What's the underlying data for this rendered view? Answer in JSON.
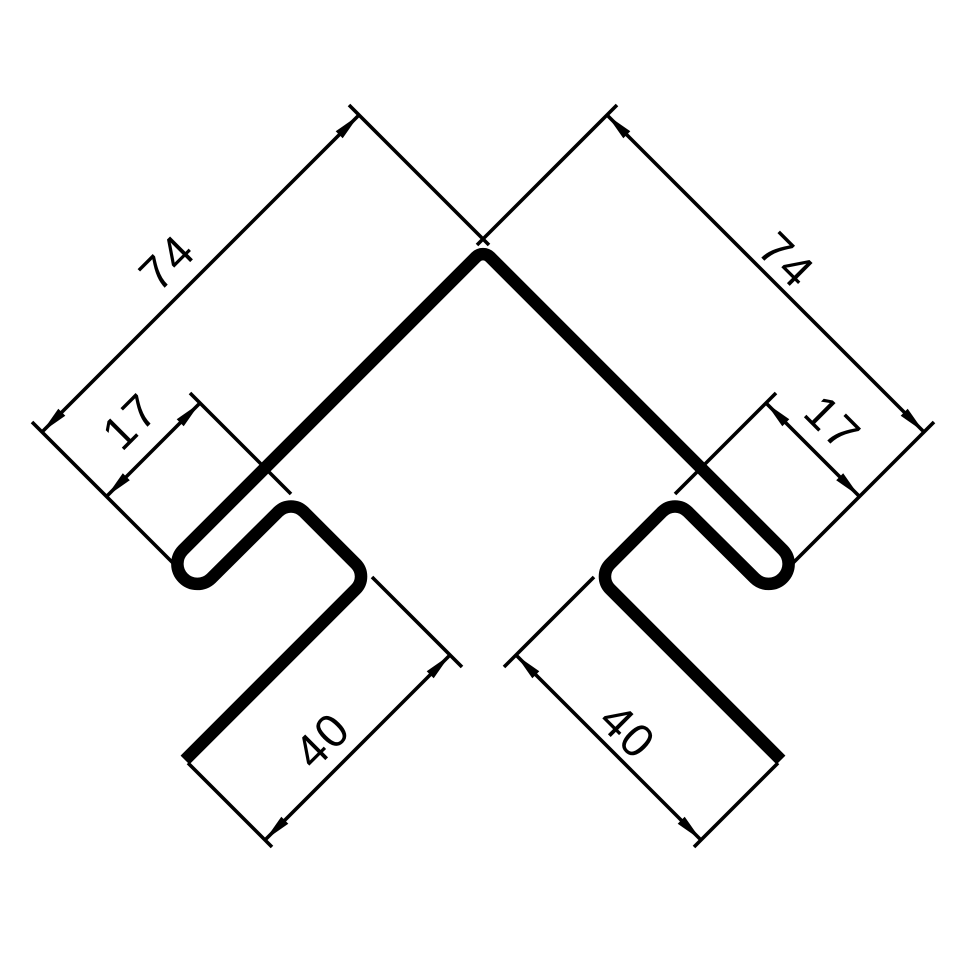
{
  "drawing": {
    "type": "technical-dimension-drawing",
    "subject": "corner-profile-cross-section",
    "background_color": "#ffffff",
    "line_color": "#000000",
    "dimensions": {
      "left_length": {
        "value": "74",
        "side": "left",
        "role": "overall-face-length"
      },
      "right_length": {
        "value": "74",
        "side": "right",
        "role": "overall-face-length"
      },
      "left_hook": {
        "value": "17",
        "side": "left",
        "role": "hook-opening"
      },
      "right_hook": {
        "value": "17",
        "side": "right",
        "role": "hook-opening"
      },
      "left_leg": {
        "value": "40",
        "side": "left",
        "role": "return-leg-length"
      },
      "right_leg": {
        "value": "40",
        "side": "right",
        "role": "return-leg-length"
      }
    }
  }
}
